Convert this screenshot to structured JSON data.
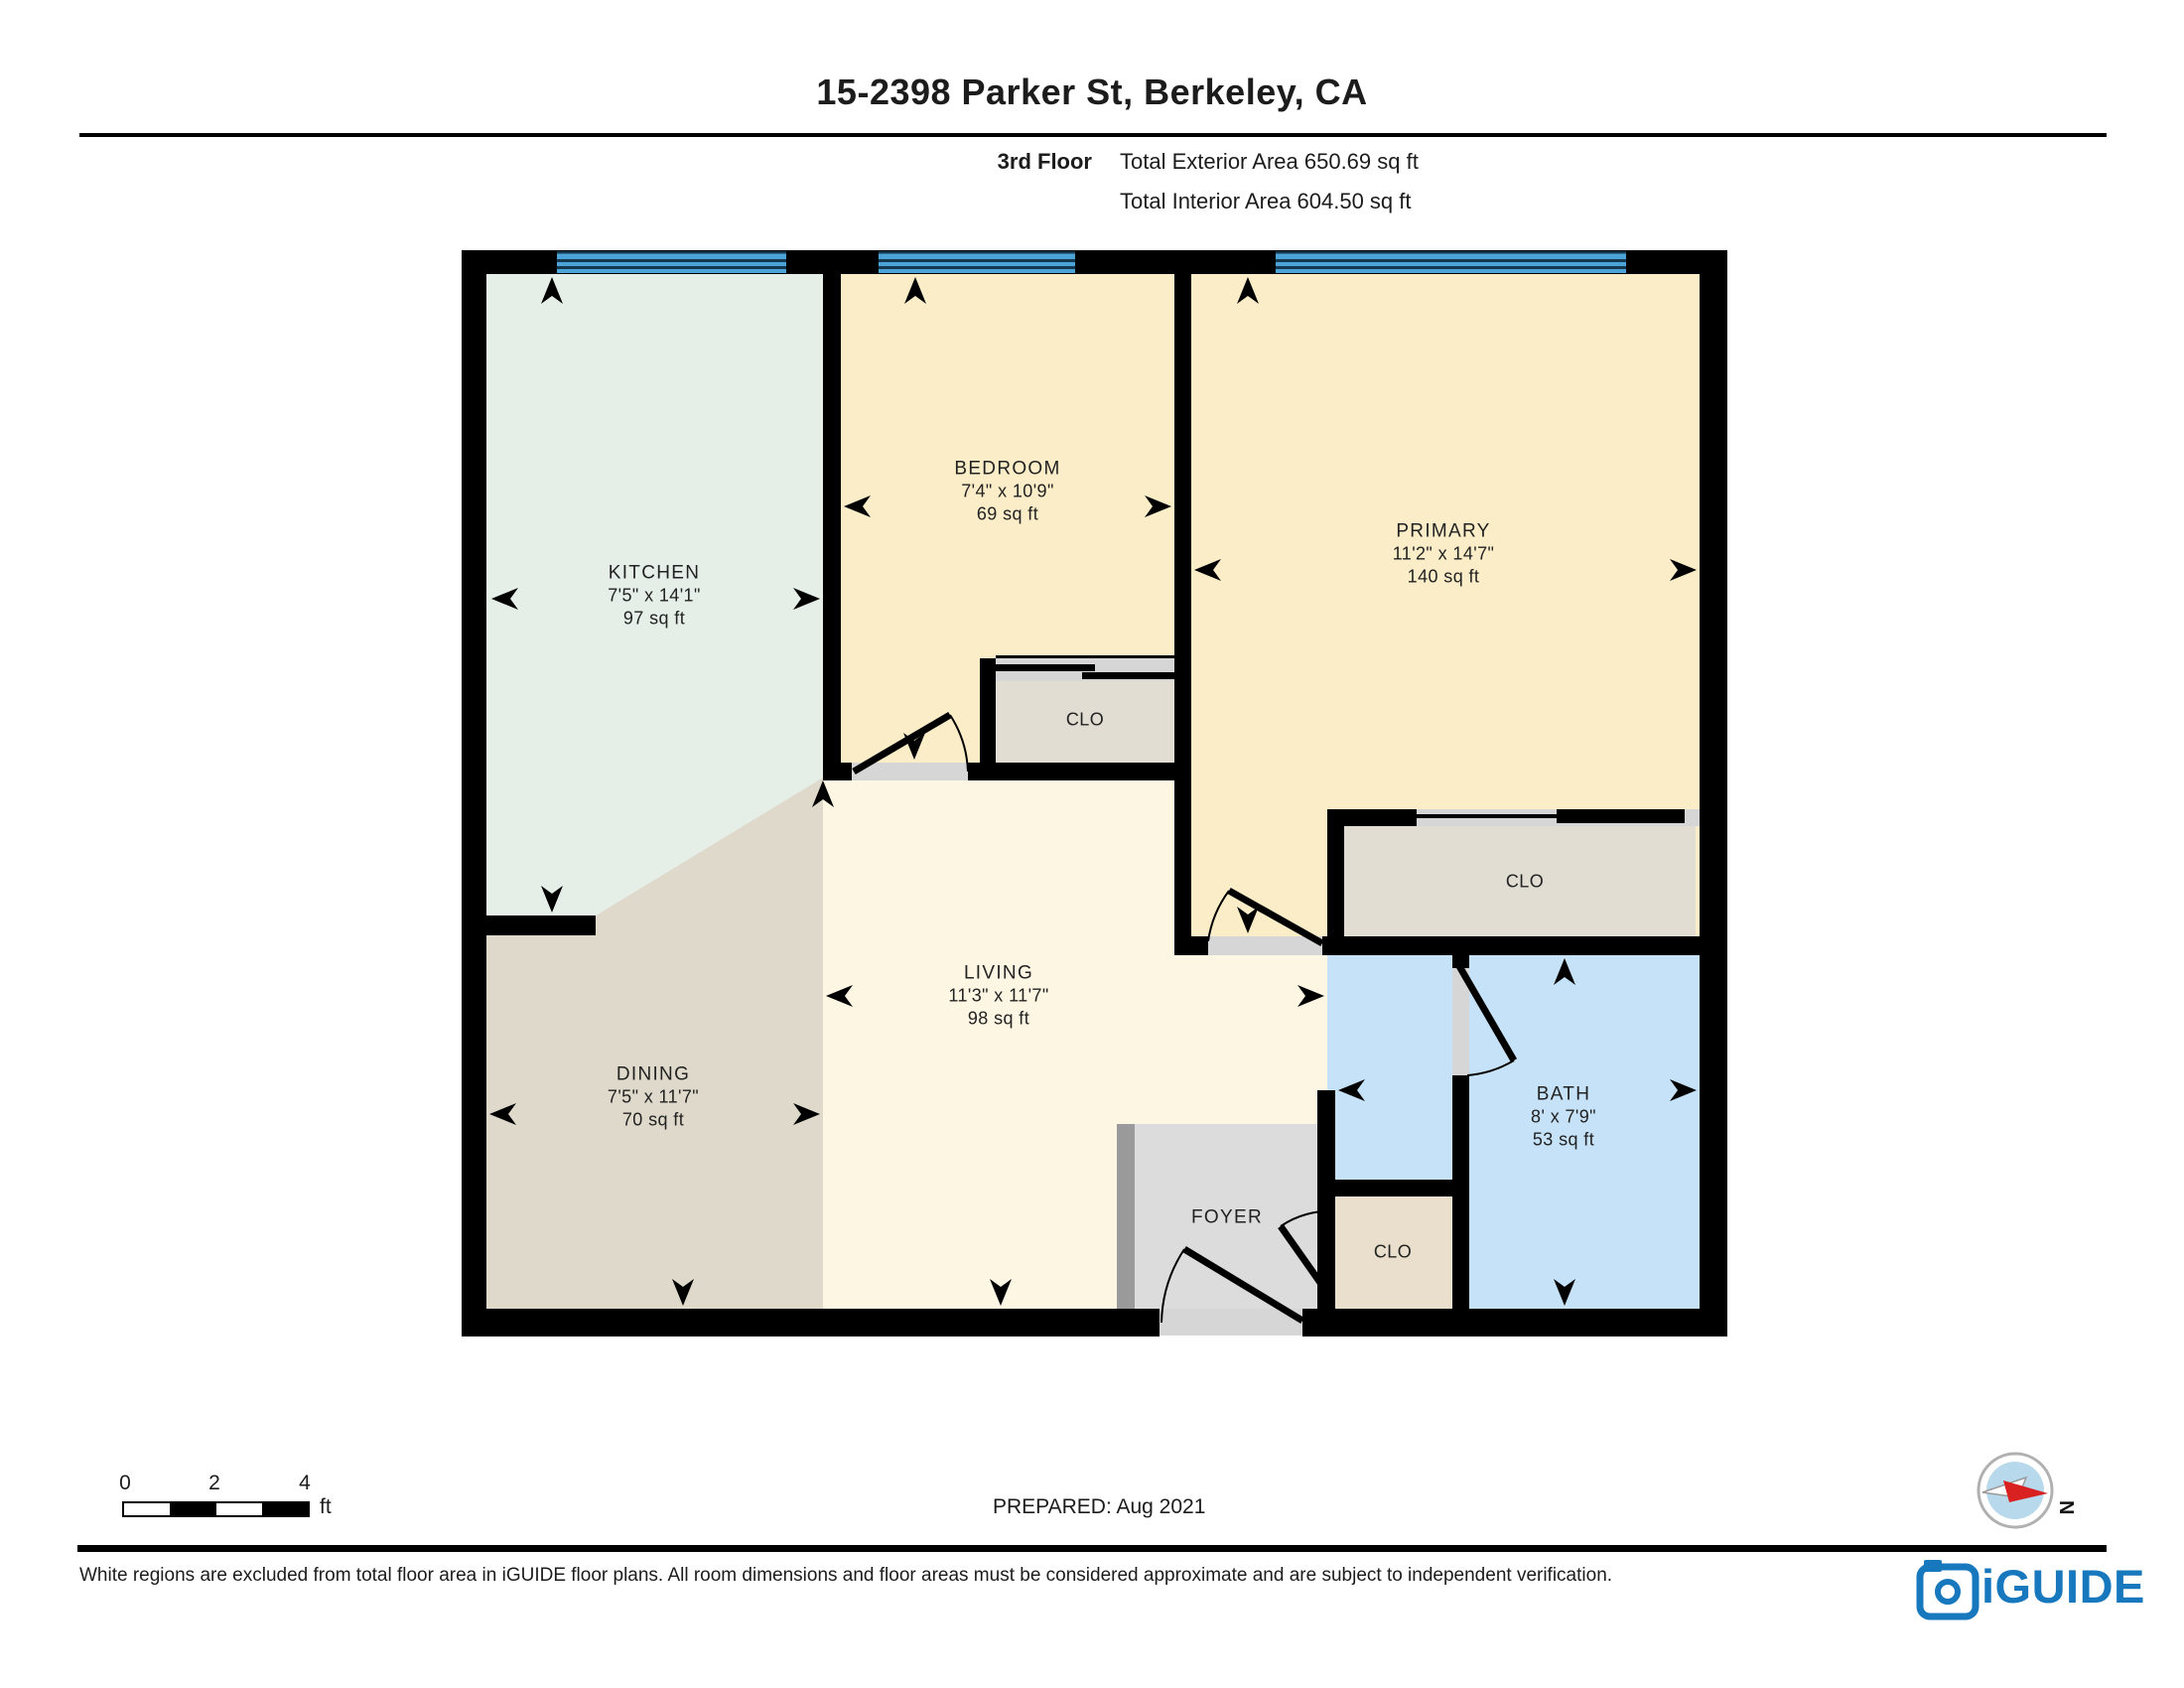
{
  "header": {
    "title": "15-2398 Parker St, Berkeley, CA",
    "floor": "3rd Floor",
    "exterior_area": "Total Exterior Area 650.69 sq ft",
    "interior_area": "Total Interior Area 604.50 sq ft"
  },
  "rooms": {
    "kitchen": {
      "name": "KITCHEN",
      "dims": "7'5\" x 14'1\"",
      "area": "97 sq ft"
    },
    "bedroom": {
      "name": "BEDROOM",
      "dims": "7'4\" x 10'9\"",
      "area": "69 sq ft"
    },
    "primary": {
      "name": "PRIMARY",
      "dims": "11'2\" x 14'7\"",
      "area": "140 sq ft"
    },
    "dining": {
      "name": "DINING",
      "dims": "7'5\" x 11'7\"",
      "area": "70 sq ft"
    },
    "living": {
      "name": "LIVING",
      "dims": "11'3\" x 11'7\"",
      "area": "98 sq ft"
    },
    "bath": {
      "name": "BATH",
      "dims": "8' x 7'9\"",
      "area": "53 sq ft"
    },
    "foyer": {
      "name": "FOYER"
    },
    "closet_bedroom": {
      "name": "CLO"
    },
    "closet_primary": {
      "name": "CLO"
    },
    "closet_foyer": {
      "name": "CLO"
    }
  },
  "scale_bar": {
    "tick0": "0",
    "tick2": "2",
    "tick4": "4",
    "unit": "ft"
  },
  "prepared": "PREPARED: Aug 2021",
  "compass": {
    "label": "N"
  },
  "footer": {
    "disclaimer": "White regions are excluded from total floor area in iGUIDE floor plans. All room dimensions and floor areas must be considered approximate and are subject to independent verification.",
    "brand": "iGUIDE"
  },
  "colors": {
    "wall": "#000000",
    "kitchen": "#e5efe8",
    "bedroom": "#fbedc7",
    "living": "#fdf6e3",
    "dining": "#ded9ca",
    "closet": "#e2ddd2",
    "closetFoyer": "#e9dfcc",
    "foyer": "#dcdcdc",
    "foyerStrip": "#9a9a9a",
    "bath": "#c6e2f8",
    "window": "#4ba3d8",
    "windowLine": "#16384e",
    "sill": "#d6d6d6",
    "brand": "#1878bd",
    "text": "#1c1c1c"
  }
}
